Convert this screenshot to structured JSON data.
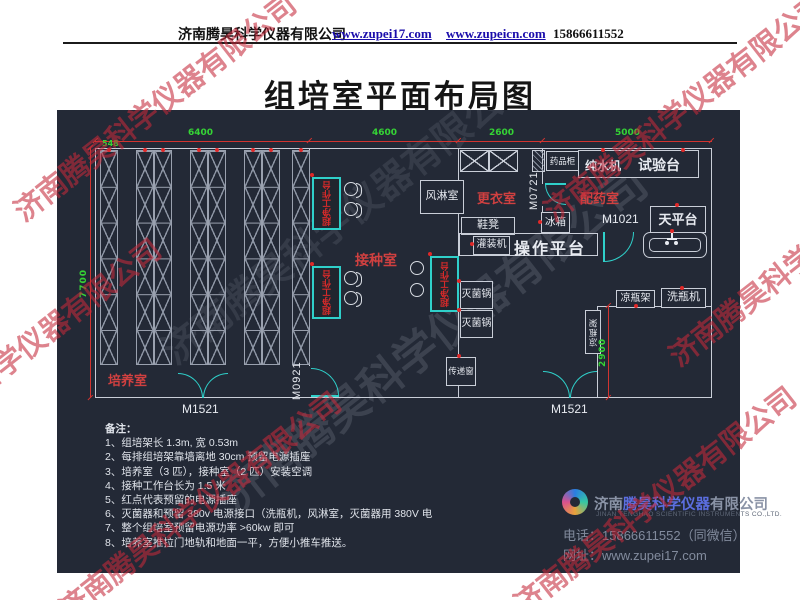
{
  "header": {
    "company": "济南腾昊科学仪器有限公司",
    "link1": "www.zupei17.com",
    "link2": "www.zupeicn.com",
    "phone": "15866611552"
  },
  "title": "组培室平面布局图",
  "watermark": {
    "text": "济南腾昊科学仪器有限公司"
  },
  "plan": {
    "dimensions": {
      "d548": "548",
      "d6400": "6400",
      "d4600": "4600",
      "d2600": "2600",
      "d5000": "5000",
      "d7700": "7700",
      "d2900": "2900"
    },
    "rooms": {
      "culture": "培养室",
      "inoculation": "接种室",
      "changing": "更衣室",
      "dispensing": "配药室"
    },
    "doors": {
      "m1521": "M1521",
      "m0921": "M0921",
      "m0721": "M0721",
      "m1021": "M1021"
    },
    "equipment": {
      "clean_bench": "超净工作台",
      "air_shower": "风淋室",
      "medicine_cabinet": "药品柜",
      "pure_water": "纯水机",
      "test_bench": "试验台",
      "shoe_bench": "鞋凳",
      "fridge": "冰箱",
      "filling_machine": "灌装机",
      "operation_platform": "操作平台",
      "balance_table": "天平台",
      "sterilizer": "灭菌锅",
      "pass_window": "传递窗",
      "bottle_rack": "凉瓶架",
      "bottle_washer": "洗瓶机"
    }
  },
  "notes": {
    "title": "备注：",
    "items": [
      "1、组培架长 1.3m, 宽 0.53m",
      "2、每排组培架靠墙离地 30cm 预留电源插座",
      "3、培养室（3 匹），接种室（2 匹）安装空调",
      "4、接种工作台长为 1.5 米",
      "5、红点代表预留的电源插座",
      "6、灭菌器和预留 380v 电源接口（洗瓶机，风淋室，灭菌器用 380V 电",
      "7、整个组培室预留电源功率 >60kw 即可",
      "8、培养室推拉门地轨和地面一平，方便小推车推送。"
    ]
  },
  "footer": {
    "company_prefix": "济南",
    "company_mid": "腾昊科学仪器",
    "company_suffix": "有限公司",
    "company_en": "JINAN TENGHAO SCIENTIFIC INSTRUMENTS CO.,LTD.",
    "phone_label": "电话：",
    "phone": "15866611552（同微信）",
    "web_label": "网址：",
    "web": "www.zupei17.com"
  },
  "colors": {
    "canvas_bg": "#232936",
    "wall": "#c9ced8",
    "door_teal": "#2fd0ca",
    "dim_red": "#d23430",
    "dim_green": "#35d435",
    "label_red": "#d04040",
    "link_blue": "#1a0dab"
  }
}
